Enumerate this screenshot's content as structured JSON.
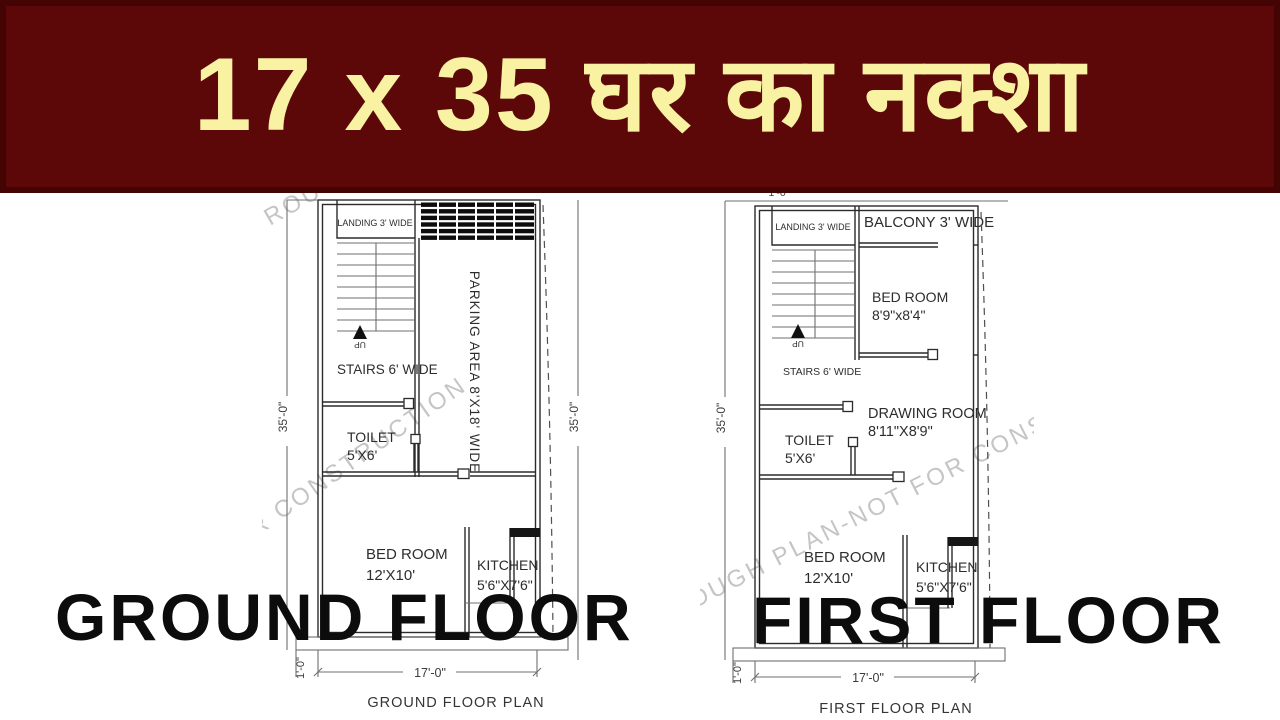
{
  "banner": {
    "title": "17 x 35 घर का नक्शा",
    "bg_color": "#5c0808",
    "border_color": "#440404",
    "text_color": "#f8f2a2"
  },
  "watermark": {
    "text": "ROUGH PLAN-NOT FOR CONSTRUCTION",
    "color": "#c5c5c5"
  },
  "ground": {
    "heading": "GROUND FLOOR",
    "caption": "GROUND FLOOR PLAN",
    "labels": {
      "landing": "LANDING 3' WIDE",
      "stairs": "STAIRS 6' WIDE",
      "up": "UP",
      "parking": "PARKING AREA 8'X18' WIDE",
      "toilet_name": "TOILET",
      "toilet_size": "5'X6'",
      "bedroom_name": "BED ROOM",
      "bedroom_size": "12'X10'",
      "kitchen_name": "KITCHEN",
      "kitchen_size": "5'6\"X7'6\"",
      "dim_left": "35'-0\"",
      "dim_right": "35'-0\"",
      "dim_bottom": "17'-0\"",
      "dim_plinth": "1'-0\""
    }
  },
  "first": {
    "heading": "FIRST FLOOR",
    "caption": "FIRST FLOOR PLAN",
    "labels": {
      "landing": "LANDING 3' WIDE",
      "balcony": "BALCONY 3' WIDE",
      "bedroom1_name": "BED ROOM",
      "bedroom1_size": "8'9\"x8'4\"",
      "stairs": "STAIRS 6' WIDE",
      "up": "UP",
      "drawing_name": "DRAWING ROOM",
      "drawing_size": "8'11\"X8'9\"",
      "toilet_name": "TOILET",
      "toilet_size": "5'X6'",
      "bedroom2_name": "BED ROOM",
      "bedroom2_size": "12'X10'",
      "kitchen_name": "KITCHEN",
      "kitchen_size": "5'6\"X7'6\"",
      "dim_left": "35'-0\"",
      "dim_top": "1'-0\"",
      "dim_bottom": "17'-0\"",
      "dim_plinth": "1'-0\""
    }
  }
}
